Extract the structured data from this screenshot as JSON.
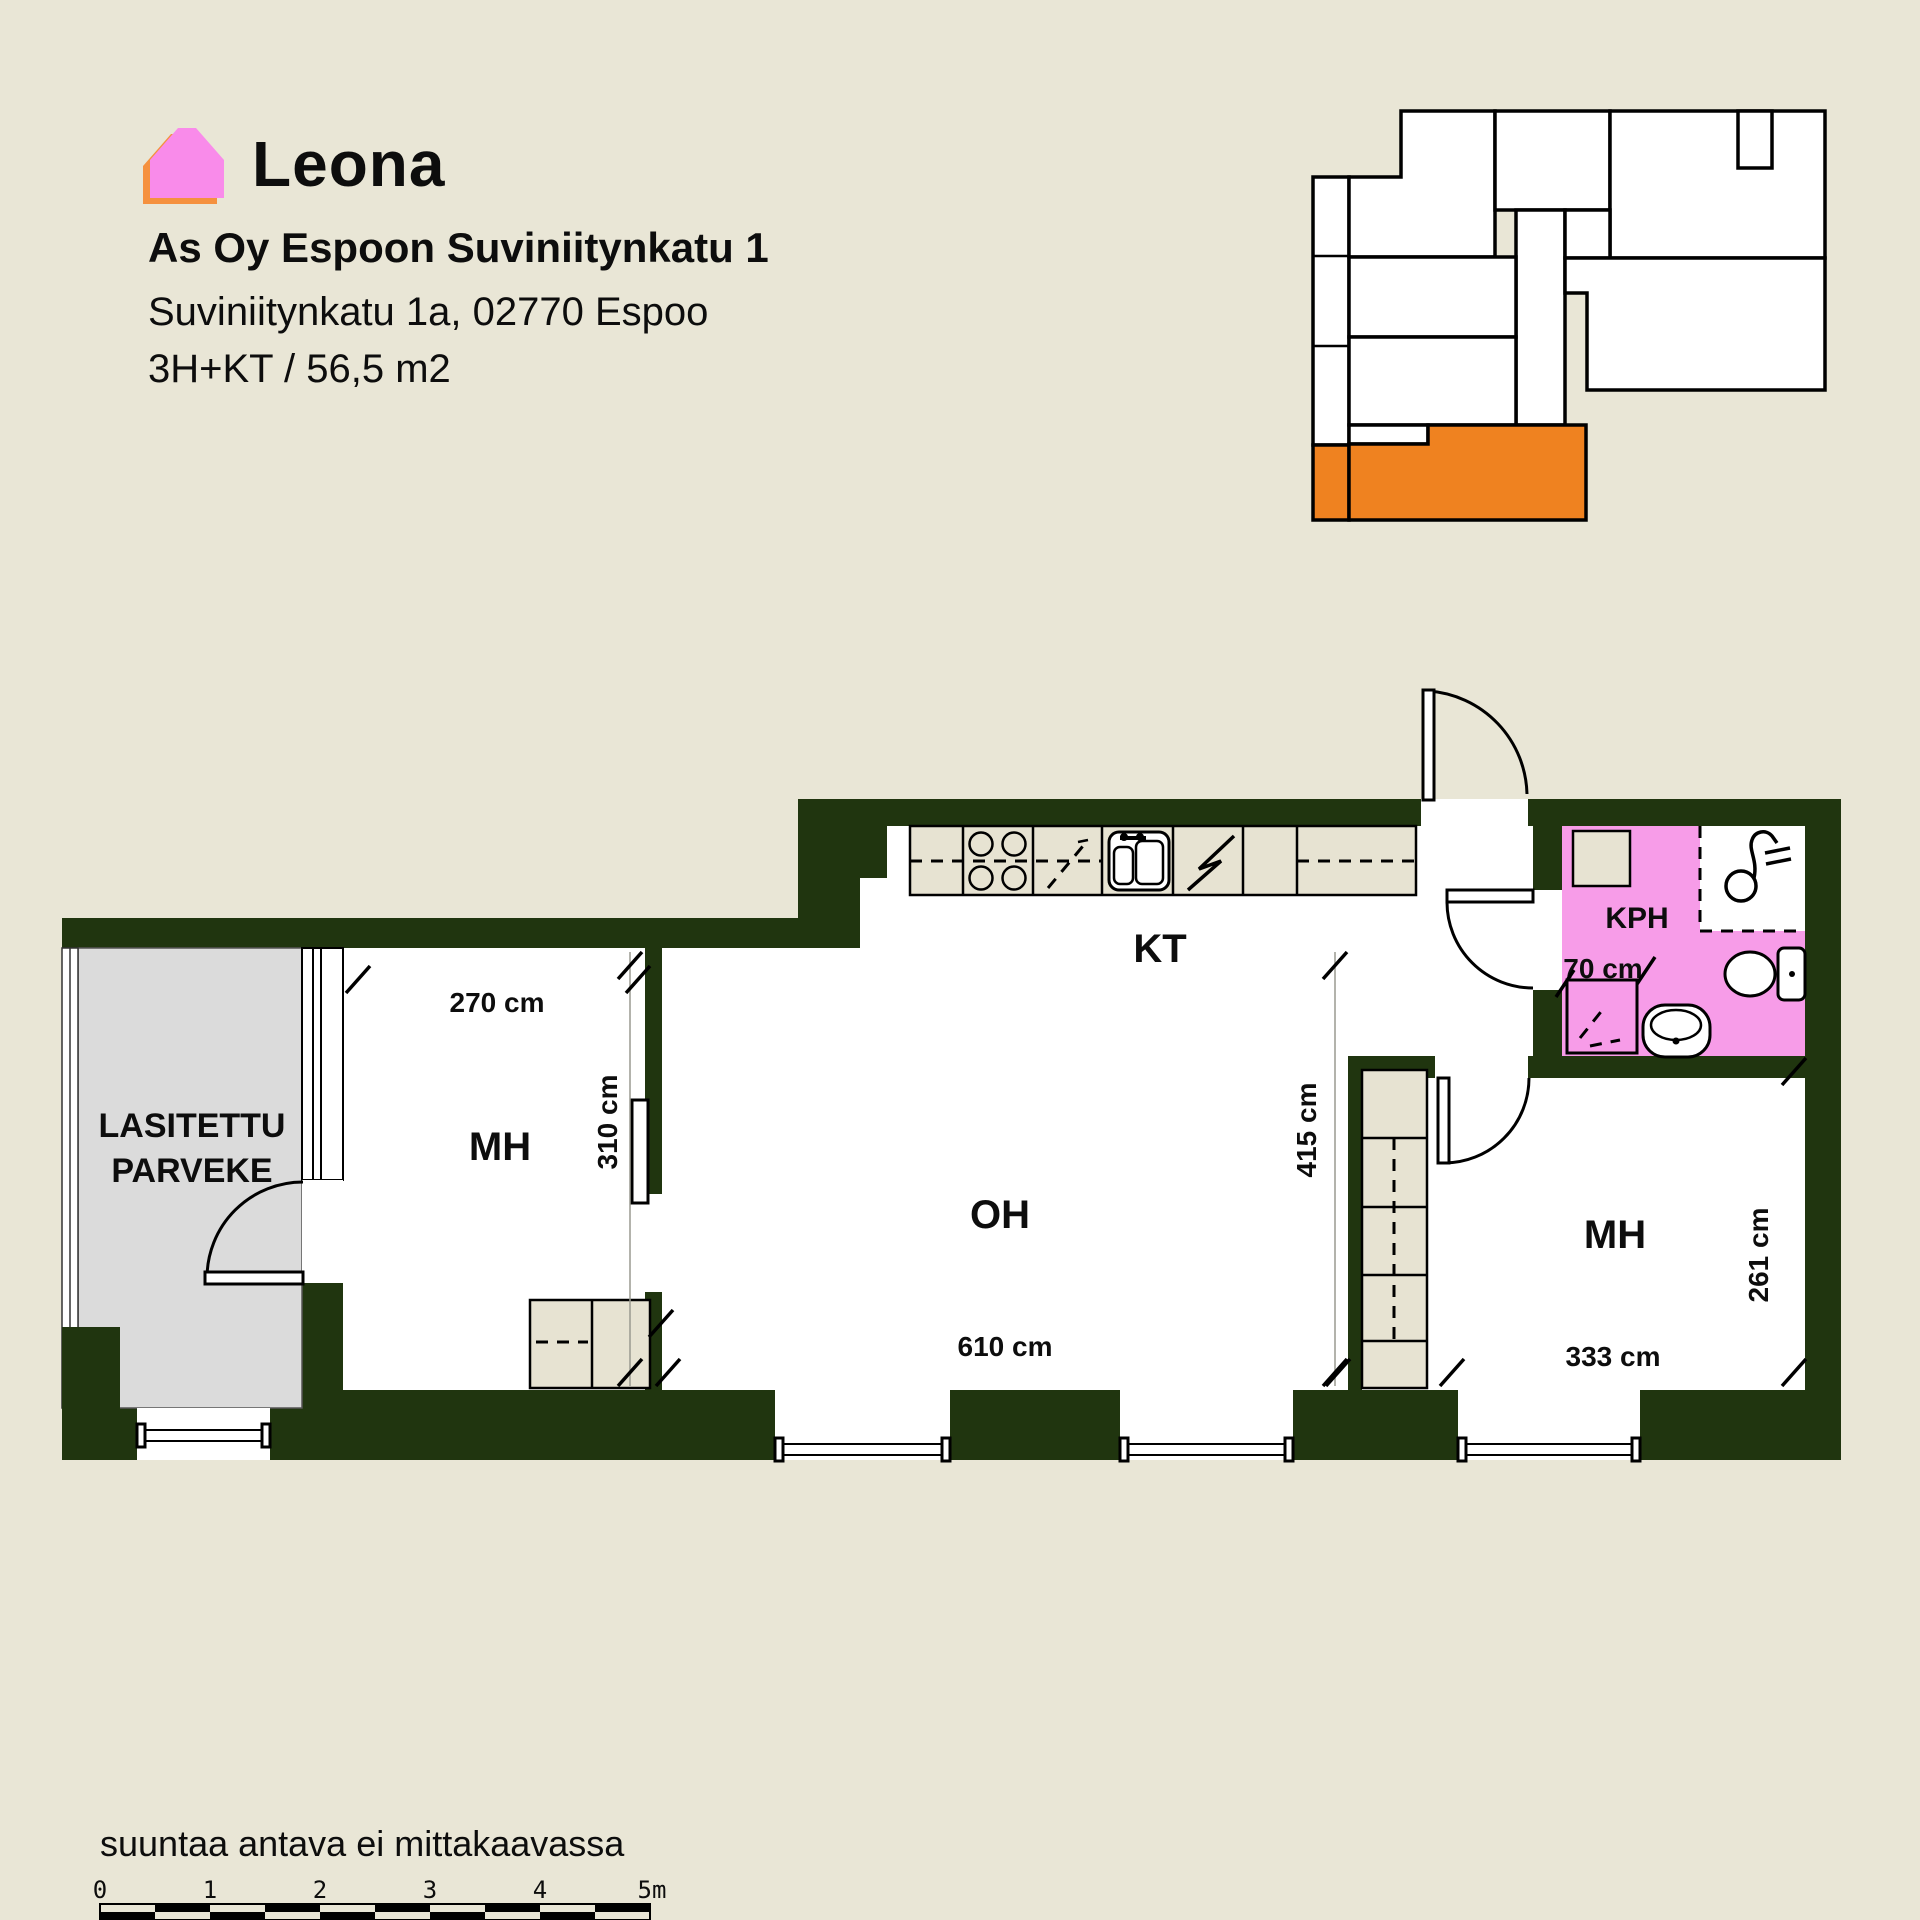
{
  "brand": "Leona",
  "header": {
    "title": "As Oy Espoon Suviniitynkatu 1",
    "address": "Suviniitynkatu 1a, 02770 Espoo",
    "spec": "3H+KT / 56,5 m2"
  },
  "plan": {
    "balcony_line1": "LASITETTU",
    "balcony_line2": "PARVEKE",
    "bedroom1": "MH",
    "living": "OH",
    "kitchen": "KT",
    "bathroom": "KPH",
    "bedroom2": "MH",
    "dims": {
      "w270": "270 cm",
      "h310": "310 cm",
      "w610": "610 cm",
      "h415": "415 cm",
      "w70": "70 cm",
      "w333": "333 cm",
      "h261": "261 cm"
    }
  },
  "footer": {
    "disclaimer": "suuntaa antava ei mittakaavassa",
    "scale_labels": [
      "0",
      "1",
      "2",
      "3",
      "4",
      "5m"
    ]
  },
  "colors": {
    "bg": "#e9e6d6",
    "wall": "#20350f",
    "balcony": "#dbdbdb",
    "furn": "#e7e3d2",
    "kph": "#f79ce8",
    "orange": "#ef8220",
    "logopink": "#f98bea",
    "logoorange": "#f5913f",
    "ink": "#0d0d0d"
  }
}
